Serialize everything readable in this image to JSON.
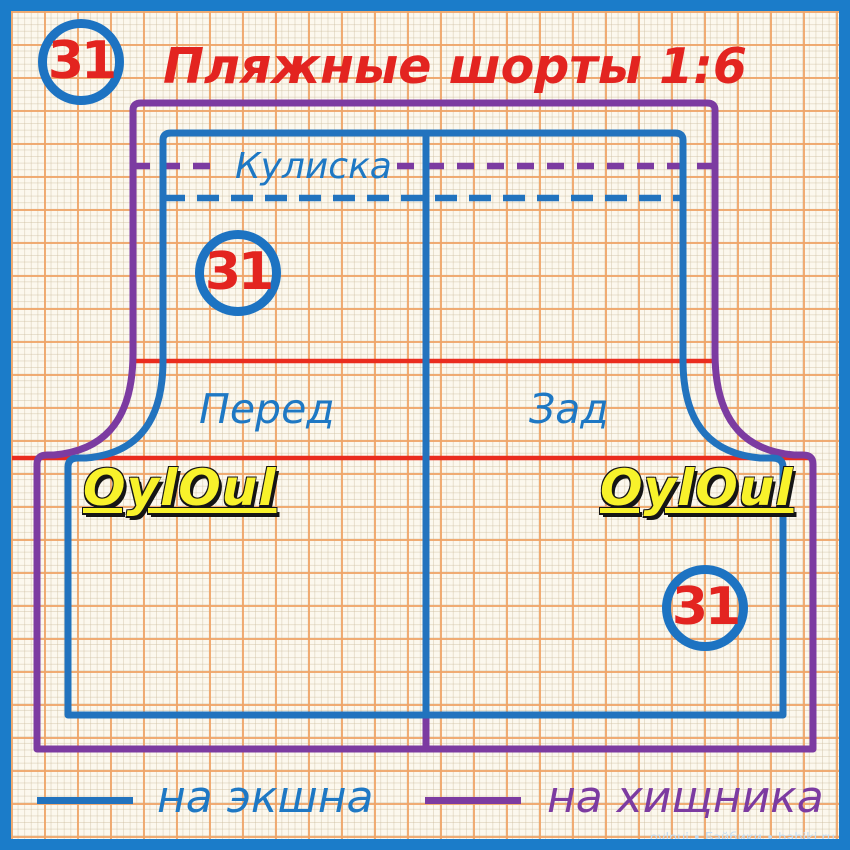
{
  "title": "Пляжные шорты 1:6",
  "badges": {
    "top_left": "31",
    "front": "31",
    "back": "31"
  },
  "labels": {
    "casing": "Кулиска",
    "front_panel": "Перед",
    "back_panel": "Зад"
  },
  "legend": {
    "action": {
      "label": "на экшна",
      "color": "#2273be"
    },
    "predator": {
      "label": "на хищника",
      "color": "#7c3ba1"
    }
  },
  "watermarks": {
    "script": "OylOul",
    "credit": "oyloui • Бэйбики • babiki.ru"
  },
  "colors": {
    "frame_blue": "#1b7cc9",
    "action_blue": "#2273be",
    "predator_purple": "#7c3ba1",
    "guide_red": "#ea2c1e",
    "title_red": "#e32420",
    "badge_red": "#e32420",
    "label_blue": "#1e78c4",
    "watermark_yellow": "#f8f22b",
    "paper_cream": "#fcf8ee",
    "grid_major_orange": "#efa467",
    "grid_minor_tan": "#d9cdb4"
  }
}
